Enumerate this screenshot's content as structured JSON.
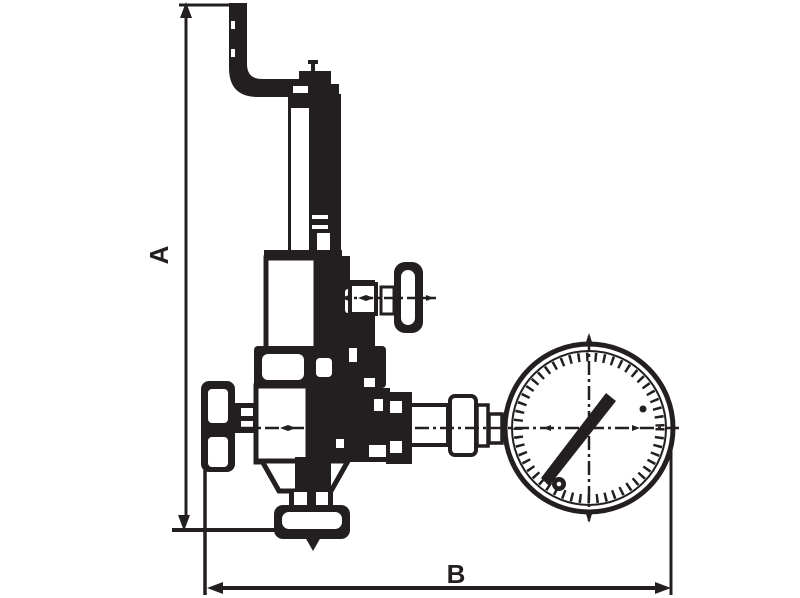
{
  "diagram": {
    "type": "technical-line-drawing",
    "subject": "Safety/overflow valve with pressure gauge - dimensional outline drawing",
    "ink_color": "#231f20",
    "background_color": "#ffffff",
    "dimensions": [
      {
        "id": "A",
        "label": "A",
        "orientation": "vertical",
        "measures": "overall height of valve from outlet base line to top of lever handle"
      },
      {
        "id": "B",
        "label": "B",
        "orientation": "horizontal",
        "measures": "overall depth from handwheel face to outer edge of pressure gauge"
      }
    ],
    "parts": [
      "lever-handle",
      "adjusting-screw-column",
      "spring-bonnet",
      "t-handle-spindle",
      "upper-flange",
      "valve-body",
      "handwheel",
      "outlet-funnel",
      "bottom-outlet-flange",
      "flow-direction-arrow",
      "gauge-connection-union",
      "pressure-gauge"
    ]
  }
}
